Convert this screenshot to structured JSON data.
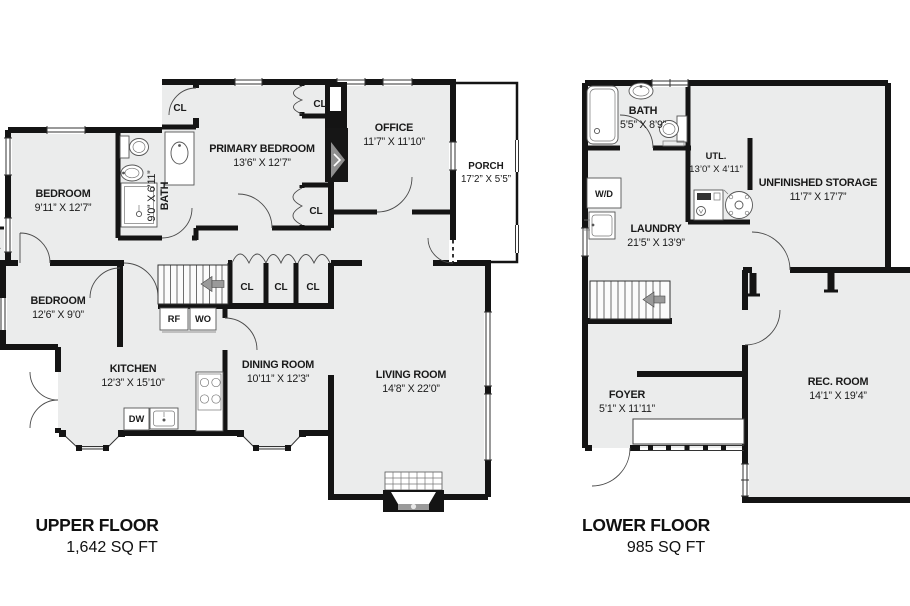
{
  "page": {
    "background": "#ffffff",
    "floor_fill": "#ebecec",
    "wall_color": "#141414",
    "arrow_color": "#9a9a9a"
  },
  "upper": {
    "title": "UPPER FLOOR",
    "area": "1,642 SQ FT",
    "rooms": {
      "bedroom_top": {
        "name": "BEDROOM",
        "dims": "9’11” X 12’7”"
      },
      "bedroom_bottom": {
        "name": "BEDROOM",
        "dims": "12’6” X 9’0”"
      },
      "bath": {
        "name": "BATH",
        "dims": "9’0” X 6’11”"
      },
      "primary_bedroom": {
        "name": "PRIMARY BEDROOM",
        "dims": "13’6” X 12’7”"
      },
      "office": {
        "name": "OFFICE",
        "dims": "11’7” X 11’10”"
      },
      "porch": {
        "name": "PORCH",
        "dims": "17’2” X 5’5”"
      },
      "kitchen": {
        "name": "KITCHEN",
        "dims": "12’3” X 15’10”"
      },
      "dining_room": {
        "name": "DINING ROOM",
        "dims": "10’11” X 12’3”"
      },
      "living_room": {
        "name": "LIVING ROOM",
        "dims": "14’8” X 22’0”"
      }
    },
    "labels": {
      "closet": "CL",
      "refrigerator": "RF",
      "wall_oven": "WO",
      "dishwasher": "DW"
    }
  },
  "lower": {
    "title": "LOWER FLOOR",
    "area": "985 SQ FT",
    "rooms": {
      "bath": {
        "name": "BATH",
        "dims": "5’5” X 8’9”"
      },
      "utility": {
        "name": "UTL.",
        "dims": "13’0” X 4’11”"
      },
      "unfinished_storage": {
        "name": "UNFINISHED STORAGE",
        "dims": "11’7” X 17’7”"
      },
      "laundry": {
        "name": "LAUNDRY",
        "dims": "21’5” X 13’9”"
      },
      "foyer": {
        "name": "FOYER",
        "dims": "5’1” X 11’11”"
      },
      "rec_room": {
        "name": "REC. ROOM",
        "dims": "14’1” X 19’4”"
      }
    },
    "labels": {
      "washer_dryer": "W/D"
    }
  }
}
